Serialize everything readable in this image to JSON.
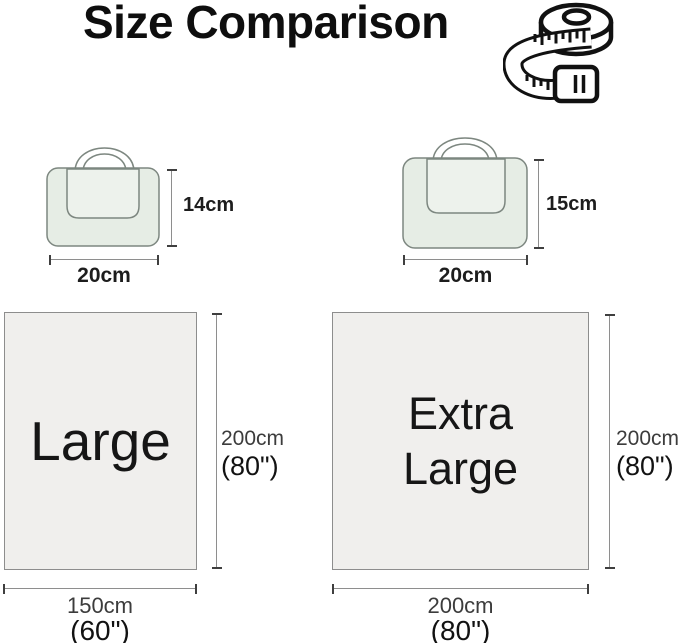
{
  "title": "Size Comparison",
  "bags": {
    "small": {
      "height": "14cm",
      "width": "20cm"
    },
    "big": {
      "height": "15cm",
      "width": "20cm"
    }
  },
  "panels": {
    "large": {
      "label": "Large",
      "side_cm": "200cm",
      "side_inch": "(80\")",
      "bottom_cm": "150cm",
      "bottom_inch": "(60\")"
    },
    "extra_large": {
      "label": "Extra Large",
      "side_cm": "200cm",
      "side_inch": "(80\")",
      "bottom_cm": "200cm",
      "bottom_inch": "(80\")"
    }
  },
  "diagram_data": {
    "items": [
      {
        "name": "Large",
        "folded_bag": "20cm x 14cm",
        "open_size": "150cm x 200cm",
        "open_size_inch": "60\" x 80\""
      },
      {
        "name": "Extra Large",
        "folded_bag": "20cm x 15cm",
        "open_size": "200cm x 200cm",
        "open_size_inch": "80\" x 80\""
      }
    ]
  },
  "colors": {
    "bag_fill": "#e6ede5",
    "bag_flap_fill": "#edf2ec",
    "bag_outline": "#7d8780",
    "panel_fill": "#f0efed",
    "panel_border": "#8d8d8d",
    "dimension_line": "#8e8e8e",
    "text_primary": "#111111",
    "text_secondary": "#3c3c3c"
  }
}
